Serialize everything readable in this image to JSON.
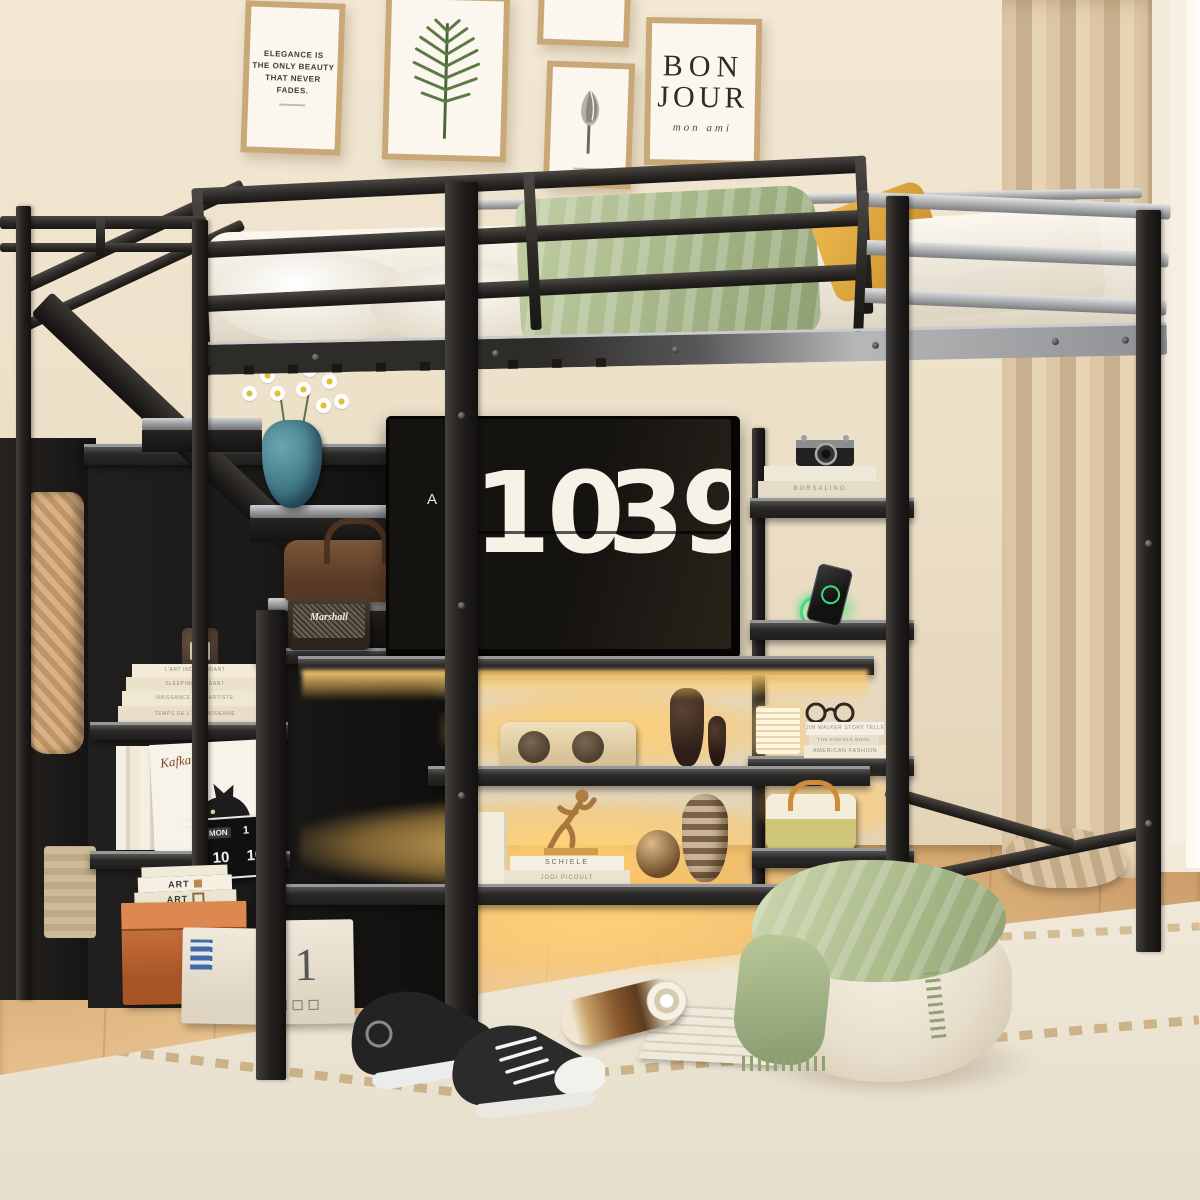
{
  "meta": {
    "scene_title": "Metal twin loft bed with storage staircase, wardrobe, LED shelves and TV stand in a bright bedroom"
  },
  "palette": {
    "wall": "#eee2cb",
    "frame_metal_dark": "#2b2825",
    "frame_metal_silver": "#aeafb1",
    "floor_wood": "#d8a470",
    "rug": "#ece4d3",
    "led_glow": "#ffd07a",
    "blanket_green": "#aebd90",
    "pillow_yellow": "#e0a93e",
    "curtain_tan": "#d4bd9c",
    "vase_teal": "#4e8a96",
    "box_orange": "#c0693a",
    "charger_green": "#3edc7e"
  },
  "wall_art": {
    "elegance": {
      "lines": [
        "ELEGANCE IS",
        "THE ONLY BEAUTY",
        "THAT NEVER",
        "FADES."
      ]
    },
    "bonjour": {
      "word1": "BON",
      "word2": "JOUR",
      "subtitle": "mon ami"
    }
  },
  "tv": {
    "brand_letter": "A",
    "clock_hours": "10",
    "clock_minutes": "39"
  },
  "flip_clock": {
    "day": "MON",
    "date": "1",
    "partial": "M",
    "hour": "10",
    "minute": "10"
  },
  "books": {
    "left_stack": [
      "L'ART INDEPENDANT",
      "SLEEPING PEASANT",
      "NAISSANCE D'UN ARTISTE",
      "TEMPS DE L'ART MODERNE"
    ],
    "camera_stack": "BORSALINO",
    "tower_stack": [
      "JIM WALKER STORY TELLER",
      "THE KINFOLK BOOK",
      "AMERICAN FASHION"
    ],
    "display_stack": [
      "SCHIELE",
      "JODI PICOULT"
    ],
    "floor_stack": "ART"
  },
  "labels": {
    "speaker_brand": "Marshall",
    "cat_print_title": "Kafka",
    "storage_box_number": "1"
  }
}
